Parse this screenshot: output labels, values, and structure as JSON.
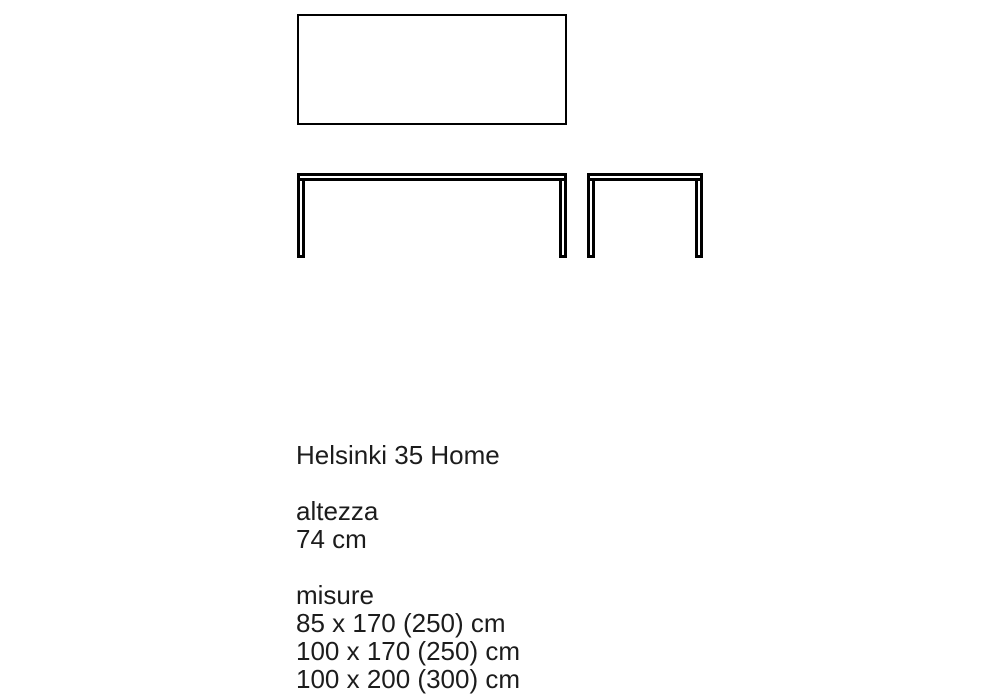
{
  "colors": {
    "background": "#ffffff",
    "drawing_line": "#000000",
    "text": "#1c1c1c"
  },
  "specs": {
    "title": "Helsinki 35 Home",
    "height": {
      "label": "altezza",
      "value": "74 cm"
    },
    "sizes": {
      "label": "misure",
      "options": [
        "85 x 170 (250) cm",
        "100 x 170 (250) cm",
        "100 x 200 (300) cm"
      ]
    }
  }
}
